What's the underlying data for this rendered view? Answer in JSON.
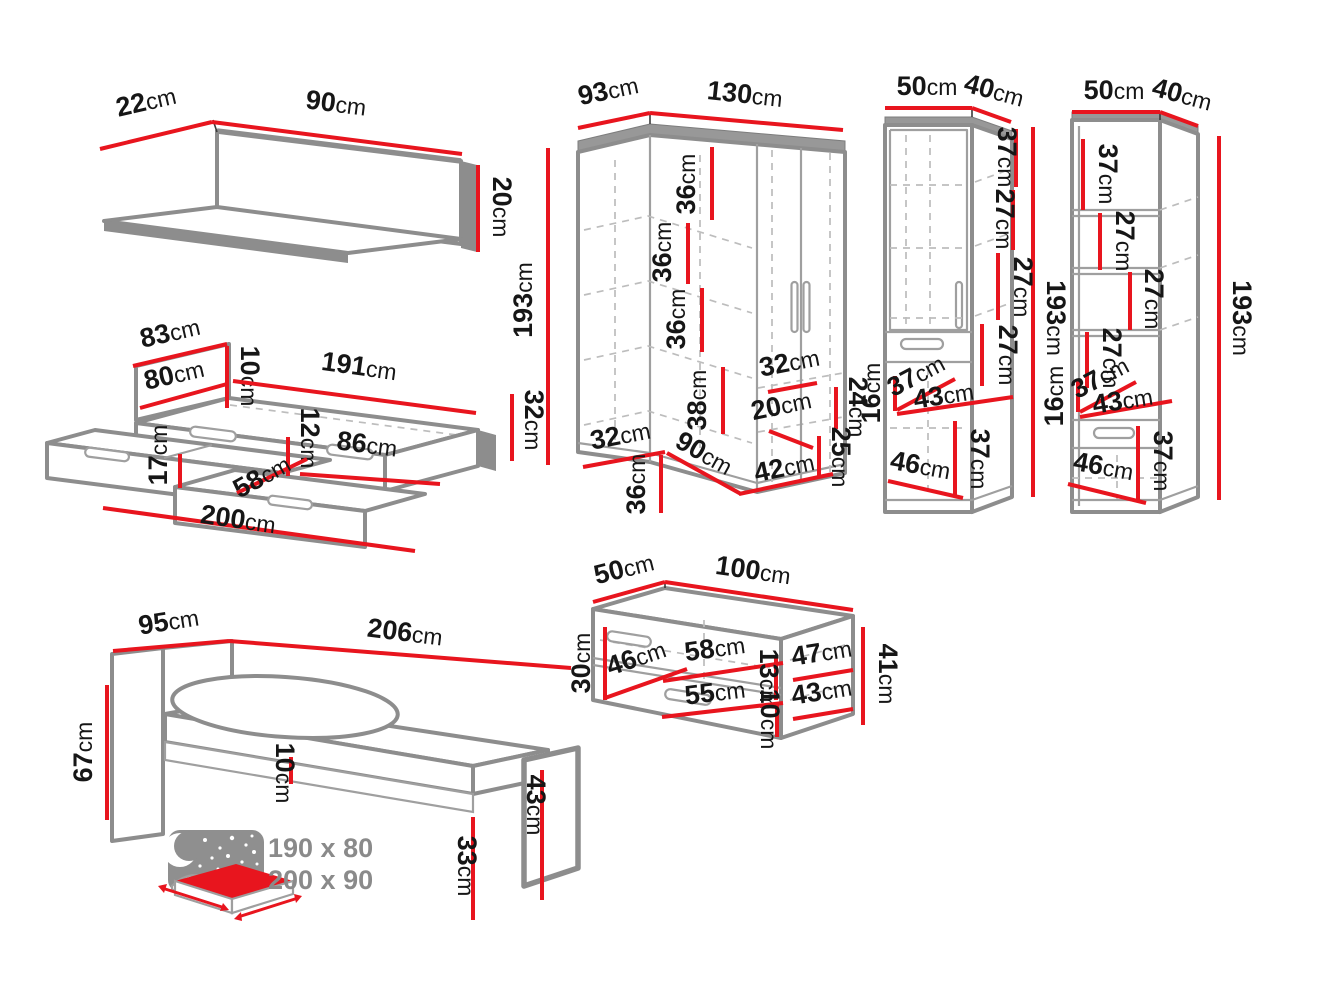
{
  "colors": {
    "dimension_red": "#e8151e",
    "outline_gray": "#8d8d8d",
    "note_gray": "#8a8a8a",
    "label_black": "#161616",
    "background": "#ffffff"
  },
  "note": {
    "sizes": [
      "190 x 80",
      "200 x 90"
    ]
  },
  "furniture": {
    "wall_shelf": {
      "name": "wall shelf",
      "dims": [
        {
          "label": "22cm",
          "x": 148,
          "y": 110,
          "rot": -13,
          "line": [
            100,
            149,
            212,
            122
          ]
        },
        {
          "label": "90cm",
          "x": 335,
          "y": 112,
          "rot": 7,
          "line": [
            212,
            122,
            462,
            154
          ]
        },
        {
          "label": "20cm",
          "x": 493,
          "y": 207,
          "rot": 90,
          "line": [
            478,
            165,
            478,
            252
          ]
        }
      ]
    },
    "bed_with_drawers": {
      "name": "bed with two drawers",
      "dims": [
        {
          "label": "83cm",
          "x": 172,
          "y": 341,
          "rot": -13,
          "line": [
            133,
            366,
            227,
            344
          ]
        },
        {
          "label": "80cm",
          "x": 176,
          "y": 383,
          "rot": -13,
          "line": [
            140,
            408,
            227,
            384
          ]
        },
        {
          "label": "10cm",
          "x": 241,
          "y": 376,
          "rot": 90,
          "line": [
            227,
            346,
            227,
            408
          ]
        },
        {
          "label": "191cm",
          "x": 358,
          "y": 375,
          "rot": 8,
          "line": [
            233,
            381,
            476,
            413
          ]
        },
        {
          "label": "32cm",
          "x": 525,
          "y": 420,
          "rot": 90,
          "line": [
            512,
            394,
            512,
            461
          ]
        },
        {
          "label": "12cm",
          "x": 301,
          "y": 438,
          "rot": 90,
          "line": [
            288,
            437,
            288,
            476
          ]
        },
        {
          "label": "86cm",
          "x": 366,
          "y": 453,
          "rot": 7,
          "line": [
            300,
            474,
            440,
            484
          ]
        },
        {
          "label": "17cm",
          "x": 167,
          "y": 455,
          "rot": -90,
          "line": [
            180,
            454,
            180,
            488
          ]
        },
        {
          "label": "58cm",
          "x": 266,
          "y": 484,
          "rot": -29,
          "line": [
            237,
            493,
            307,
            459
          ]
        },
        {
          "label": "200cm",
          "x": 237,
          "y": 528,
          "rot": 8,
          "line": [
            103,
            508,
            415,
            551
          ]
        }
      ]
    },
    "corner_wardrobe": {
      "name": "corner wardrobe",
      "dims": [
        {
          "label": "93cm",
          "x": 610,
          "y": 99,
          "rot": -12,
          "line": [
            578,
            128,
            650,
            113
          ]
        },
        {
          "label": "130cm",
          "x": 744,
          "y": 103,
          "rot": 6,
          "line": [
            650,
            113,
            843,
            130
          ]
        },
        {
          "label": "193cm",
          "x": 532,
          "y": 300,
          "rot": -90,
          "line": [
            548,
            148,
            548,
            465
          ]
        },
        {
          "label": "36cm",
          "x": 695,
          "y": 184,
          "rot": -90,
          "line": [
            712,
            147,
            712,
            220
          ]
        },
        {
          "label": "36cm",
          "x": 671,
          "y": 252,
          "rot": -90,
          "line": [
            688,
            223,
            688,
            284
          ]
        },
        {
          "label": "36cm",
          "x": 685,
          "y": 319,
          "rot": -90,
          "line": [
            702,
            288,
            702,
            352
          ]
        },
        {
          "label": "38cm",
          "x": 706,
          "y": 400,
          "rot": -90,
          "line": [
            723,
            367,
            723,
            434
          ]
        },
        {
          "label": "32cm",
          "x": 791,
          "y": 371,
          "rot": -11,
          "line": [
            768,
            392,
            817,
            383
          ]
        },
        {
          "label": "20cm",
          "x": 783,
          "y": 414,
          "rot": -12,
          "line": [
            769,
            431,
            813,
            448
          ]
        },
        {
          "label": "24cm",
          "x": 849,
          "y": 407,
          "rot": 90,
          "line": [
            836,
            387,
            836,
            429
          ]
        },
        {
          "label": "25cm",
          "x": 832,
          "y": 457,
          "rot": 90,
          "line": [
            819,
            436,
            819,
            478
          ]
        },
        {
          "label": "32cm",
          "x": 622,
          "y": 444,
          "rot": -11,
          "line": [
            583,
            467,
            665,
            452
          ]
        },
        {
          "label": "36cm",
          "x": 645,
          "y": 484,
          "rot": -90,
          "line": [
            661,
            455,
            661,
            513
          ]
        },
        {
          "label": "90cm",
          "x": 700,
          "y": 461,
          "rot": 29,
          "line": [
            667,
            453,
            741,
            494
          ]
        },
        {
          "label": "42cm",
          "x": 786,
          "y": 476,
          "rot": -12,
          "line": [
            739,
            494,
            833,
            474
          ]
        }
      ]
    },
    "tall_cabinet_left": {
      "name": "tall cabinet with door and drawer",
      "dims": [
        {
          "label": "50cm",
          "x": 927,
          "y": 95,
          "rot": 0,
          "line": [
            885,
            108,
            972,
            108
          ]
        },
        {
          "label": "40cm",
          "x": 992,
          "y": 99,
          "rot": 15,
          "line": [
            972,
            108,
            1011,
            122
          ]
        },
        {
          "label": "193cm",
          "x": 1047,
          "y": 318,
          "rot": 90,
          "line": [
            1033,
            127,
            1033,
            497
          ]
        },
        {
          "label": "37cm",
          "x": 998,
          "y": 157,
          "rot": 90,
          "line": [
            1016,
            129,
            1016,
            187
          ]
        },
        {
          "label": "27cm",
          "x": 996,
          "y": 219,
          "rot": 90,
          "line": [
            1013,
            190,
            1013,
            250
          ]
        },
        {
          "label": "27cm",
          "x": 1014,
          "y": 287,
          "rot": 90,
          "line": [
            998,
            253,
            998,
            320
          ]
        },
        {
          "label": "27cm",
          "x": 999,
          "y": 355,
          "rot": 90,
          "line": [
            982,
            324,
            982,
            386
          ]
        },
        {
          "label": "16cm",
          "x": 880,
          "y": 393,
          "rot": -90,
          "line": [
            895,
            376,
            895,
            411
          ]
        },
        {
          "label": "37cm",
          "x": 920,
          "y": 383,
          "rot": -28,
          "line": [
            897,
            410,
            955,
            379
          ]
        },
        {
          "label": "43cm",
          "x": 945,
          "y": 404,
          "rot": -9,
          "line": [
            897,
            414,
            1013,
            397
          ]
        },
        {
          "label": "37cm",
          "x": 971,
          "y": 459,
          "rot": 90,
          "line": [
            955,
            421,
            955,
            497
          ]
        },
        {
          "label": "46cm",
          "x": 919,
          "y": 474,
          "rot": 10,
          "line": [
            888,
            481,
            963,
            498
          ]
        }
      ]
    },
    "tall_cabinet_right": {
      "name": "tall cabinet with open shelves",
      "dims": [
        {
          "label": "50cm",
          "x": 1114,
          "y": 99,
          "rot": 0,
          "line": [
            1072,
            112,
            1160,
            112
          ]
        },
        {
          "label": "40cm",
          "x": 1180,
          "y": 103,
          "rot": 15,
          "line": [
            1160,
            112,
            1198,
            126
          ]
        },
        {
          "label": "193cm",
          "x": 1233,
          "y": 318,
          "rot": 90,
          "line": [
            1219,
            136,
            1219,
            500
          ]
        },
        {
          "label": "37cm",
          "x": 1099,
          "y": 174,
          "rot": 90,
          "line": [
            1083,
            139,
            1083,
            210
          ]
        },
        {
          "label": "27cm",
          "x": 1116,
          "y": 241,
          "rot": 90,
          "line": [
            1100,
            213,
            1100,
            270
          ]
        },
        {
          "label": "27cm",
          "x": 1145,
          "y": 299,
          "rot": 90,
          "line": [
            1130,
            272,
            1130,
            330
          ]
        },
        {
          "label": "27cm",
          "x": 1103,
          "y": 358,
          "rot": 90,
          "line": [
            1087,
            332,
            1087,
            388
          ]
        },
        {
          "label": "16cm",
          "x": 1063,
          "y": 396,
          "rot": -90,
          "line": [
            1078,
            380,
            1078,
            412
          ]
        },
        {
          "label": "37cm",
          "x": 1104,
          "y": 385,
          "rot": -28,
          "line": [
            1080,
            412,
            1136,
            382
          ]
        },
        {
          "label": "43cm",
          "x": 1124,
          "y": 409,
          "rot": -9,
          "line": [
            1080,
            417,
            1172,
            401
          ]
        },
        {
          "label": "37cm",
          "x": 1154,
          "y": 461,
          "rot": 90,
          "line": [
            1138,
            426,
            1138,
            500
          ]
        },
        {
          "label": "46cm",
          "x": 1102,
          "y": 475,
          "rot": 10,
          "line": [
            1068,
            484,
            1146,
            503
          ]
        }
      ]
    },
    "low_cabinet": {
      "name": "low cabinet with drawer",
      "dims": [
        {
          "label": "50cm",
          "x": 626,
          "y": 577,
          "rot": -14,
          "line": [
            593,
            602,
            665,
            582
          ]
        },
        {
          "label": "100cm",
          "x": 752,
          "y": 579,
          "rot": 8,
          "line": [
            665,
            582,
            853,
            610
          ]
        },
        {
          "label": "30cm",
          "x": 590,
          "y": 663,
          "rot": -90,
          "line": [
            605,
            627,
            605,
            700
          ]
        },
        {
          "label": "46cm",
          "x": 639,
          "y": 666,
          "rot": -19,
          "line": [
            605,
            698,
            687,
            669
          ]
        },
        {
          "label": "58cm",
          "x": 716,
          "y": 657,
          "rot": -8,
          "line": [
            663,
            681,
            783,
            663
          ]
        },
        {
          "label": "13cm",
          "x": 760,
          "y": 679,
          "rot": 90,
          "line": [
            776,
            658,
            776,
            700
          ]
        },
        {
          "label": "47cm",
          "x": 823,
          "y": 661,
          "rot": -9,
          "line": [
            793,
            680,
            853,
            670
          ]
        },
        {
          "label": "41cm",
          "x": 879,
          "y": 674,
          "rot": 90,
          "line": [
            863,
            627,
            863,
            725
          ]
        },
        {
          "label": "55cm",
          "x": 716,
          "y": 701,
          "rot": -7,
          "line": [
            662,
            717,
            783,
            703
          ]
        },
        {
          "label": "43cm",
          "x": 823,
          "y": 700,
          "rot": -9,
          "line": [
            793,
            719,
            853,
            709
          ]
        },
        {
          "label": "10cm",
          "x": 761,
          "y": 719,
          "rot": 90,
          "line": [
            777,
            702,
            777,
            737
          ]
        }
      ]
    },
    "bed": {
      "name": "bed with mattress",
      "dims": [
        {
          "label": "95cm",
          "x": 170,
          "y": 630,
          "rot": -9,
          "line": [
            113,
            651,
            229,
            641
          ]
        },
        {
          "label": "206cm",
          "x": 404,
          "y": 641,
          "rot": 7,
          "line": [
            229,
            641,
            571,
            668
          ]
        },
        {
          "label": "67cm",
          "x": 92,
          "y": 752,
          "rot": -90,
          "line": [
            107,
            685,
            107,
            820
          ]
        },
        {
          "label": "10cm",
          "x": 276,
          "y": 773,
          "rot": 90,
          "line": [
            291,
            757,
            291,
            784
          ]
        },
        {
          "label": "43cm",
          "x": 527,
          "y": 805,
          "rot": 90,
          "line": [
            542,
            770,
            542,
            900
          ]
        },
        {
          "label": "33cm",
          "x": 458,
          "y": 866,
          "rot": 90,
          "line": [
            473,
            817,
            473,
            920
          ]
        }
      ]
    }
  }
}
